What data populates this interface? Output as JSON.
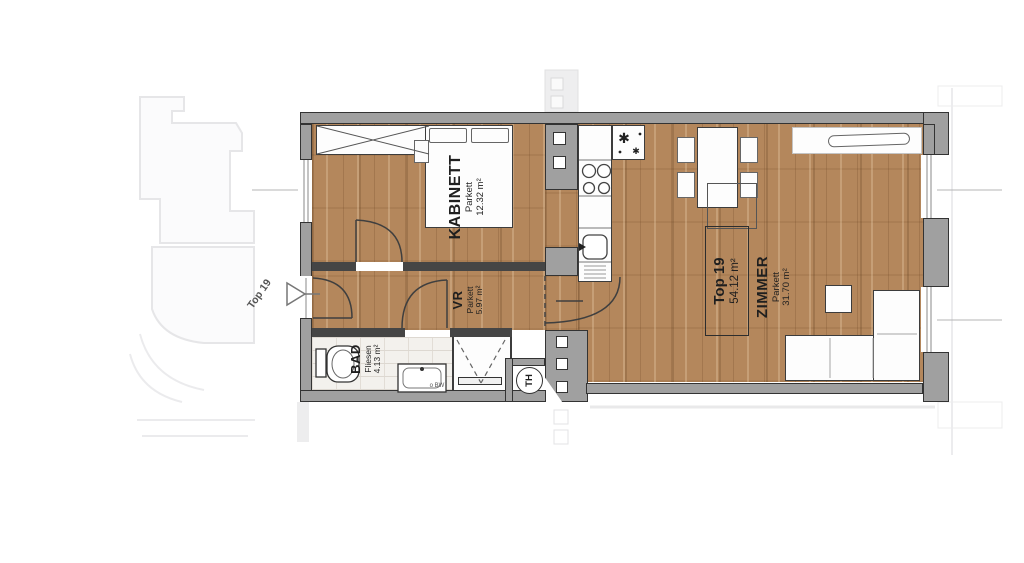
{
  "page": {
    "background": "#ffffff"
  },
  "unit_label_box": {
    "title": "Top 19",
    "area": "54.12 m²"
  },
  "entrance_marker": {
    "label": "Top 19"
  },
  "rooms": [
    {
      "name": "KABINETT",
      "floor_type": "Parkett",
      "area": "12.32 m²"
    },
    {
      "name": "VR",
      "floor_type": "Parkett",
      "area": "5.97 m²"
    },
    {
      "name": "BAD",
      "floor_type": "Fliesen",
      "area": "4.13 m²"
    },
    {
      "name": "ZIMMER",
      "floor_type": "Parkett",
      "area": "31.70 m²"
    }
  ],
  "fixtures": {
    "boiler_label": "TH",
    "basin_note": "o BW",
    "freezer_symbol": "✱"
  },
  "colors": {
    "wood": "#b4875c",
    "wall_gray": "#a0a0a0",
    "wall_dark": "#454545",
    "tile": "#f3f1ed",
    "faint_outline": "#e6e6e8"
  }
}
